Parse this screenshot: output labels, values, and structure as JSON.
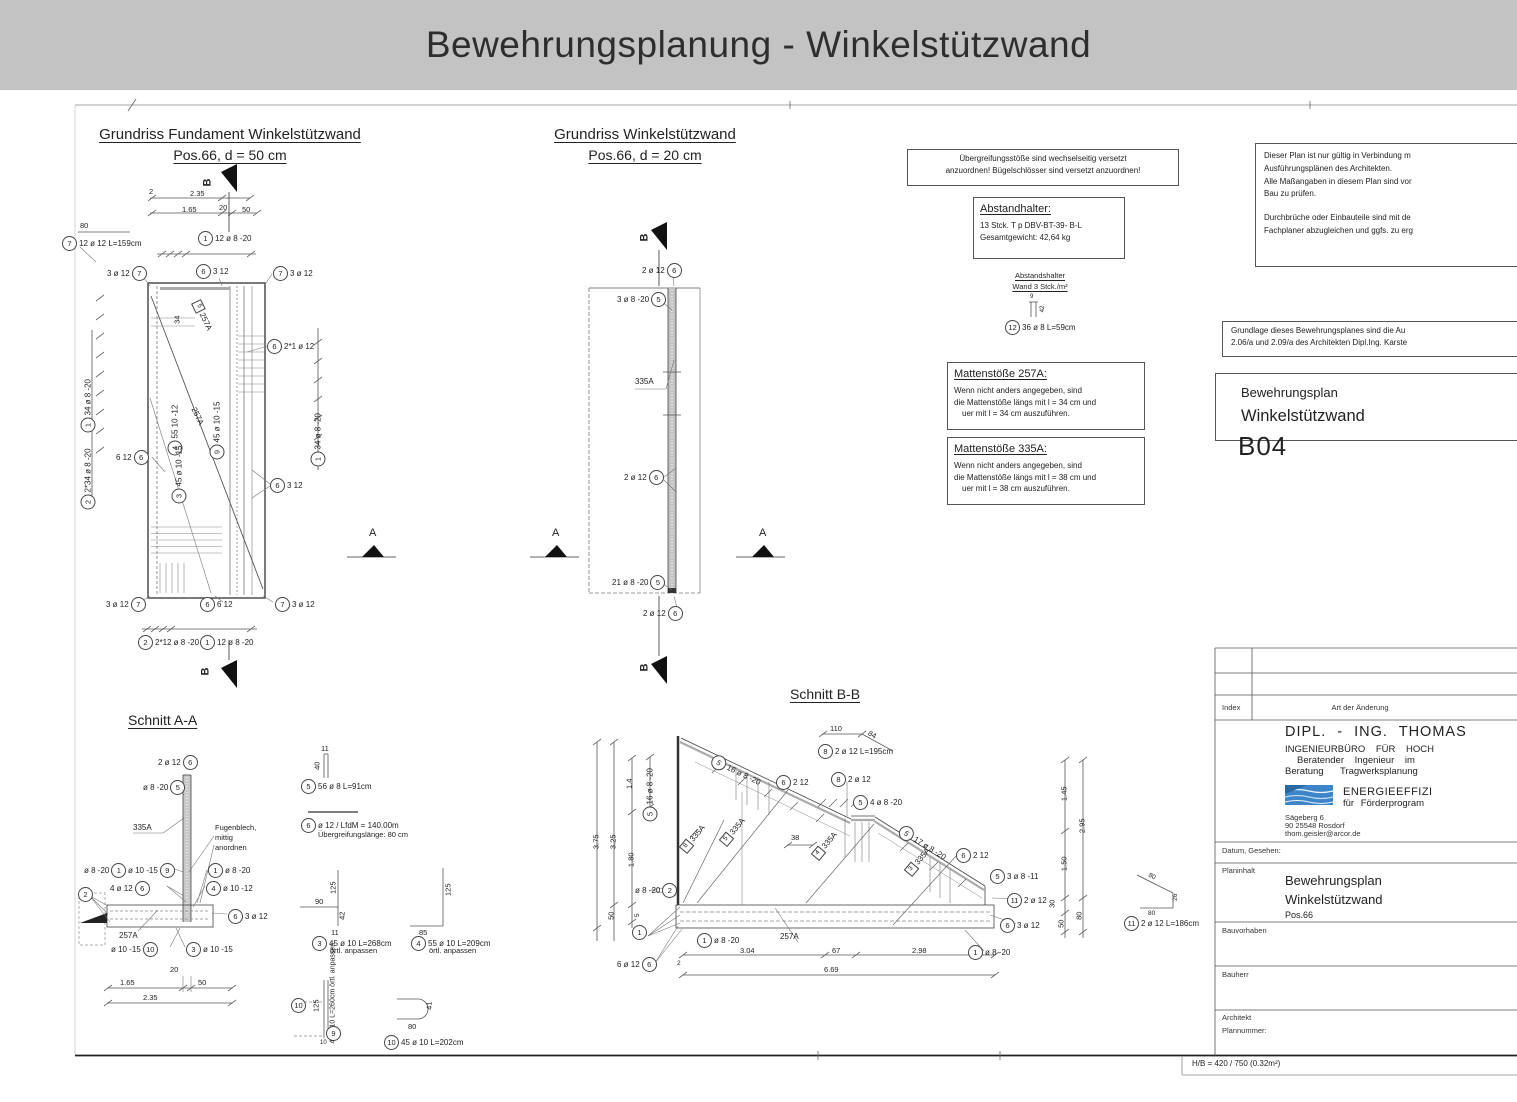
{
  "colors": {
    "header_bg": "#c3c3c3",
    "logo_blue": "#3d85c8",
    "line": "#444444"
  },
  "header": {
    "title": "Bewehrungsplanung - Winkelstützwand"
  },
  "sheet": {
    "format": "H/B = 420 / 750 (0.32m²)"
  },
  "fundament": {
    "title": "Grundriss Fundament Winkelstützwand",
    "subtitle": "Pos.66, d = 50 cm",
    "marker": "B",
    "mat": "257A",
    "mat_sq": "5",
    "dims": {
      "d80": "80",
      "d2": "2",
      "d235": "2.35",
      "d20": "20",
      "d165": "1.65",
      "d50": "50",
      "d34": "34"
    },
    "callouts": [
      {
        "n": "7",
        "t": "12 ø 12 L=159cm"
      },
      {
        "n": "1",
        "t": "12 ø 8 -20"
      },
      {
        "n": "6",
        "t": "3  12"
      },
      {
        "n": "7",
        "t": "3 ø 12"
      },
      {
        "t": "3 ø 12",
        "n": "7"
      },
      {
        "n": "6",
        "t": "2*1 ø 12"
      },
      {
        "n": "6",
        "t": "3  12"
      },
      {
        "t": "6  12",
        "n": "6"
      },
      {
        "t": "3 ø 12",
        "n": "7"
      },
      {
        "n": "6",
        "t": "6  12"
      },
      {
        "n": "7",
        "t": "3 ø 12"
      },
      {
        "n": "2",
        "t": "2*12 ø 8 -20"
      },
      {
        "n": "1",
        "t": "12 ø 8 -20"
      }
    ],
    "vlabels": [
      {
        "n": "1",
        "t": "34 ø 8 -20"
      },
      {
        "n": "2",
        "t": "2*34 ø 8 -20"
      },
      {
        "n": "1",
        "t": "34 ø 8 -20"
      },
      {
        "n": "4",
        "t": "55  10 -12"
      },
      {
        "n": "3",
        "t": "45 ø 10 -15"
      },
      {
        "n": "9",
        "t": "45 ø 10 -15"
      }
    ]
  },
  "wallplan": {
    "title": "Grundriss Winkelstützwand",
    "subtitle": "Pos.66, d = 20 cm",
    "marker": "B",
    "mat": "335A",
    "callouts": [
      {
        "t": "2 ø 12",
        "n": "6"
      },
      {
        "t": "3 ø 8 -20",
        "n": "5"
      },
      {
        "t": "2 ø 12",
        "n": "6"
      },
      {
        "t": "21 ø 8 -20",
        "n": "5"
      },
      {
        "t": "2 ø 12",
        "n": "6"
      }
    ]
  },
  "sections": {
    "a": "A"
  },
  "notes": {
    "stoesse": [
      "Übergreifungsstöße sind wechselseitig versetzt",
      "anzuordnen! Bügelschlösser sind versetzt anzuordnen!"
    ],
    "abstandhalter": {
      "h": "Abstandhalter:",
      "l1": "13 Stck. T p DBV-BT-39- B-L",
      "l2": "Gesamtgewicht: 42,64 kg"
    },
    "wand": [
      "Abstandshalter",
      "Wand 3 Stck./m²"
    ],
    "pos12": {
      "n": "12",
      "t": "36 ø 8 L=59cm",
      "d1": "9",
      "d2": "42"
    },
    "m257": {
      "h": "Mattenstöße    257A:",
      "l1": "Wenn nicht anders angegeben, sind",
      "l2": "die Mattenstöße längs mit l = 34 cm und",
      "l3": "uer mit l = 34 cm auszuführen."
    },
    "m335": {
      "h": "Mattenstöße    335A:",
      "l1": "Wenn nicht anders angegeben, sind",
      "l2": "die Mattenstöße längs mit l = 38 cm und",
      "l3": "uer mit l = 38 cm auszuführen."
    },
    "validity": [
      "Dieser Plan ist nur gültig in Verbindung m",
      "Ausführungsplänen des Architekten.",
      "Alle Maßangaben in diesem Plan sind vor",
      "Bau zu prüfen.",
      "Durchbrüche oder Einbauteile sind mit de",
      "Fachplaner abzugleichen und ggfs. zu erg"
    ],
    "grundlage": [
      "Grundlage dieses Bewehrungsplanes sind die Au",
      "2.06/a und 2.09/a des Architekten Dipl.Ing. Karste"
    ],
    "plantitle": {
      "l1": "Bewehrungsplan",
      "l2": "Winkelstützwand",
      "code": "B04"
    }
  },
  "schnittAA": {
    "title": "Schnitt A-A",
    "mat1": "335A",
    "mat2": "257A",
    "fugenblech": [
      "Fugenblech,",
      "mittig",
      "anordnen"
    ],
    "callouts": [
      {
        "t": "2 ø 12",
        "n": "6"
      },
      {
        "t": "ø 8 -20",
        "n": "5"
      },
      {
        "t": "ø 8 -20",
        "n": "1"
      },
      {
        "t": "ø 10 -15",
        "n": "9"
      },
      {
        "n": "1",
        "t": "ø 8 -20"
      },
      {
        "t": "4 ø 12",
        "n": "6"
      },
      {
        "n": "4",
        "t": "ø 10 -12"
      },
      {
        "n": "2",
        "t": ""
      },
      {
        "n": "6",
        "t": "3 ø 12"
      },
      {
        "t": "ø 10 -15",
        "n": "10"
      },
      {
        "n": "3",
        "t": "ø 10 -15"
      }
    ],
    "dims": {
      "d20": "20",
      "d165": "1.65",
      "d50": "50",
      "d235": "2.35"
    }
  },
  "shapes": [
    {
      "n": "5",
      "t": "56 ø 8 L=91cm",
      "d1": "11",
      "d2": "40"
    },
    {
      "n": "6",
      "t": "ø 12 / LfdM = 140.00m",
      "sub": "Übergreifungslänge: 80 cm"
    },
    {
      "n": "3",
      "t": "45 ø 10 L=268cm",
      "sub": "örtl. anpassen",
      "d1": "90",
      "d2": "125",
      "d3": "42",
      "d4": "11"
    },
    {
      "n": "4",
      "t": "55 ø 10 L=209cm",
      "sub": "örtl. anpassen",
      "d1": "125",
      "d2": "85"
    },
    {
      "n": "10",
      "n2": "9",
      "t": "45 ø 10 L=260cm",
      "sub": "örtl. anpassen",
      "d1": "125",
      "d2": "10"
    },
    {
      "n": "10",
      "t": "45 ø 10 L=202cm",
      "d1": "80",
      "d2": "41"
    }
  ],
  "schnittBB": {
    "title": "Schnitt B-B",
    "mat": "335A",
    "mat2": "257A",
    "sq": [
      "8",
      "5",
      "4",
      "3"
    ],
    "callouts": [
      {
        "n": "5",
        "t": "16 ø 8 -20"
      },
      {
        "n": "6",
        "t": "2  12"
      },
      {
        "n": "8",
        "t": "2 ø 12"
      },
      {
        "n": "5",
        "t": "4 ø 8 -20"
      },
      {
        "n": "5",
        "t": "17 ø 8 -20"
      },
      {
        "n": "6",
        "t": "2  12"
      },
      {
        "n": "5",
        "t": "3 ø 8 -11"
      },
      {
        "n": "11",
        "t": "2 ø 12"
      },
      {
        "n": "6",
        "t": "3 ø 12"
      },
      {
        "n": "1",
        "t": "ø 8 -20"
      },
      {
        "t": "ø 8 -20",
        "n": "2"
      },
      {
        "n": "1",
        "t": ""
      },
      {
        "t": "6 ø 12",
        "n": "6"
      },
      {
        "n": "1",
        "t": "ø 8 -20"
      },
      {
        "n": "5",
        "t": "16 ø 8 -20"
      },
      {
        "n": "11",
        "t": "2 ø 12 L=186cm"
      },
      {
        "n": "8",
        "t": "2 ø 12 L=195cm"
      }
    ],
    "dims": {
      "d375": "3.75",
      "d325": "3.25",
      "d180": "1.80",
      "d14": "1.4",
      "d50l": "50",
      "d5": "5",
      "d2": "2",
      "d304": "3.04",
      "d67": "67",
      "d298": "2.98",
      "d669": "6.69",
      "d38": "38",
      "d145": "1.45",
      "d150": "1.50",
      "d30": "30",
      "d50r": "50",
      "d295": "2.95",
      "d80r": "80",
      "d110": "110",
      "d84": "84",
      "s80a": "80",
      "s26": "26",
      "s80b": "80"
    }
  },
  "titleblock": {
    "index": "Index",
    "art": "Art der Änderung",
    "company": [
      "DIPL. - ING.  THOMAS",
      "INGENIEURBÜRO   FÜR   HOCH",
      "Beratender    Ingenieur    im",
      "Beratung        Tragwerksplanung"
    ],
    "energy": [
      "ENERGIEEFFIZI",
      "für  Förderprogram"
    ],
    "address": [
      "Sägeberg 6",
      "90 25548 Rosdorf",
      "thom.geisler@arcor.de"
    ],
    "datum": "Datum, Gesehen:",
    "planinhalt_label": "Planinhalt",
    "planinhalt": [
      "Bewehrungsplan",
      "Winkelstützwand",
      "Pos.66"
    ],
    "bauvorhaben": "Bauvorhaben",
    "bauherr": "Bauherr",
    "architekt": "Architekt",
    "plannummer": "Plannummer:"
  }
}
